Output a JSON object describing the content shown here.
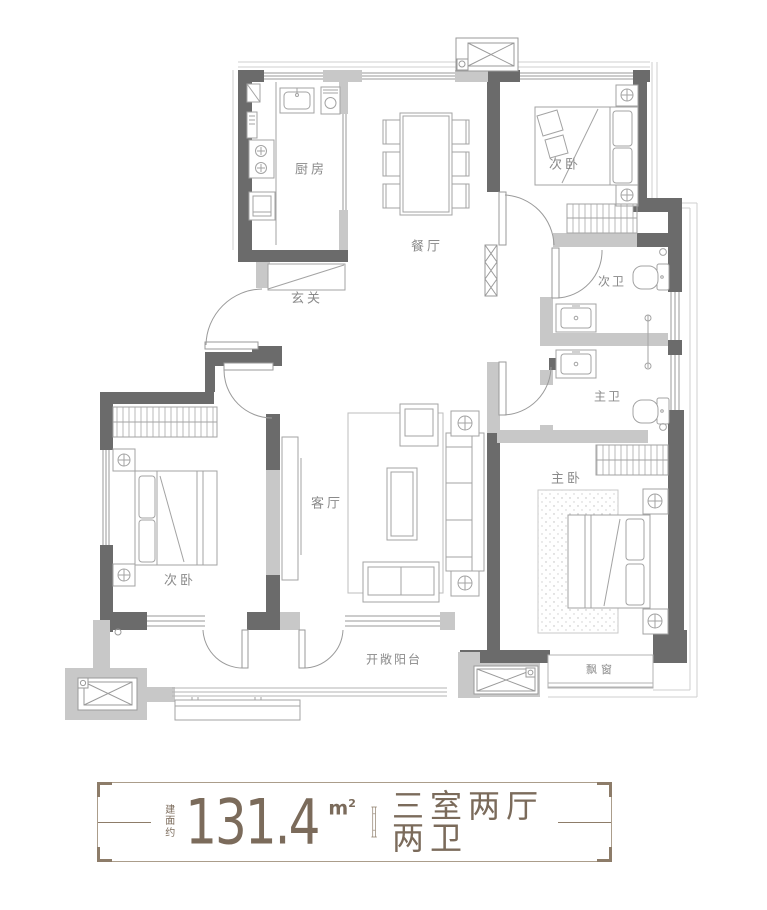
{
  "rooms": {
    "kitchen": "厨房",
    "dining": "餐厅",
    "entry": "玄关",
    "bedroom_top": "次卧",
    "bath_secondary": "次卫",
    "bath_master": "主卫",
    "bedroom_master": "主卧",
    "living": "客厅",
    "bedroom_left": "次卧",
    "balcony": "开敞阳台",
    "bay_window": "飘窗"
  },
  "footer": {
    "area_prefix": "建面约",
    "area_value": "131.4",
    "area_unit": "m",
    "area_unit_exp": "2",
    "layout_text": "三室两厅两卫"
  },
  "colors": {
    "wall_dark": "#6b6b6b",
    "wall_light": "#c8c8c8",
    "furniture_line": "#a3a3a3",
    "room_label": "#8a8a8a",
    "footer_text": "#7b6b5b",
    "footer_border": "#ab9d8b"
  }
}
